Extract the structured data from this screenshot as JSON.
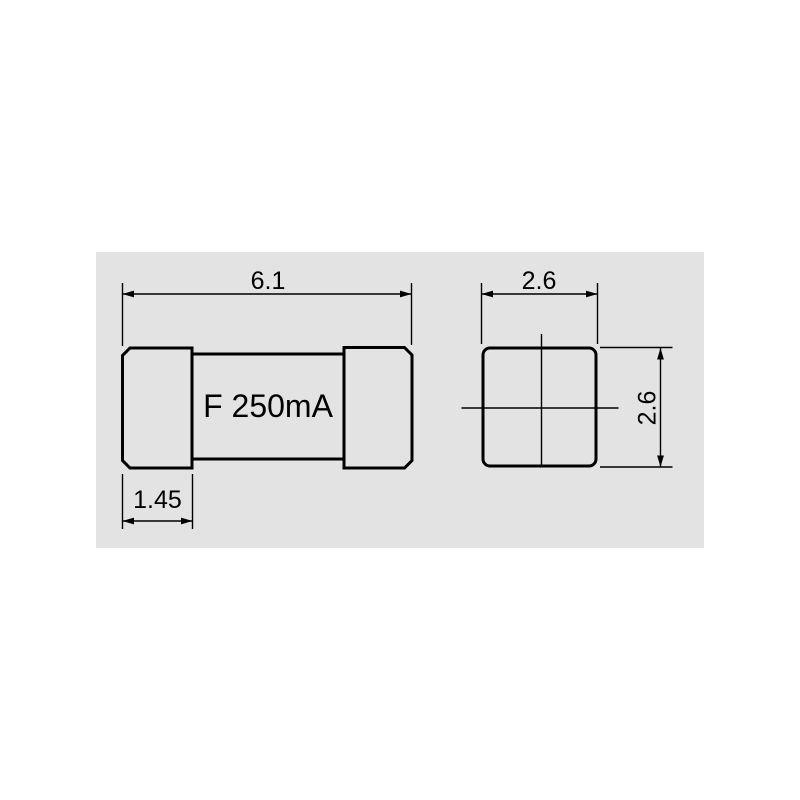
{
  "page": {
    "background_color": "#ffffff"
  },
  "panel": {
    "background_color": "#e3e3e3"
  },
  "drawing": {
    "type": "technical-dimension-drawing",
    "subject": "SMD fuse",
    "line_color": "#000000",
    "text_color": "#000000"
  },
  "fuse": {
    "marking": "F 250mA",
    "dimensions": {
      "overall_length": "6.1",
      "cap_length": "1.45",
      "end_width": "2.6",
      "end_height": "2.6"
    }
  }
}
